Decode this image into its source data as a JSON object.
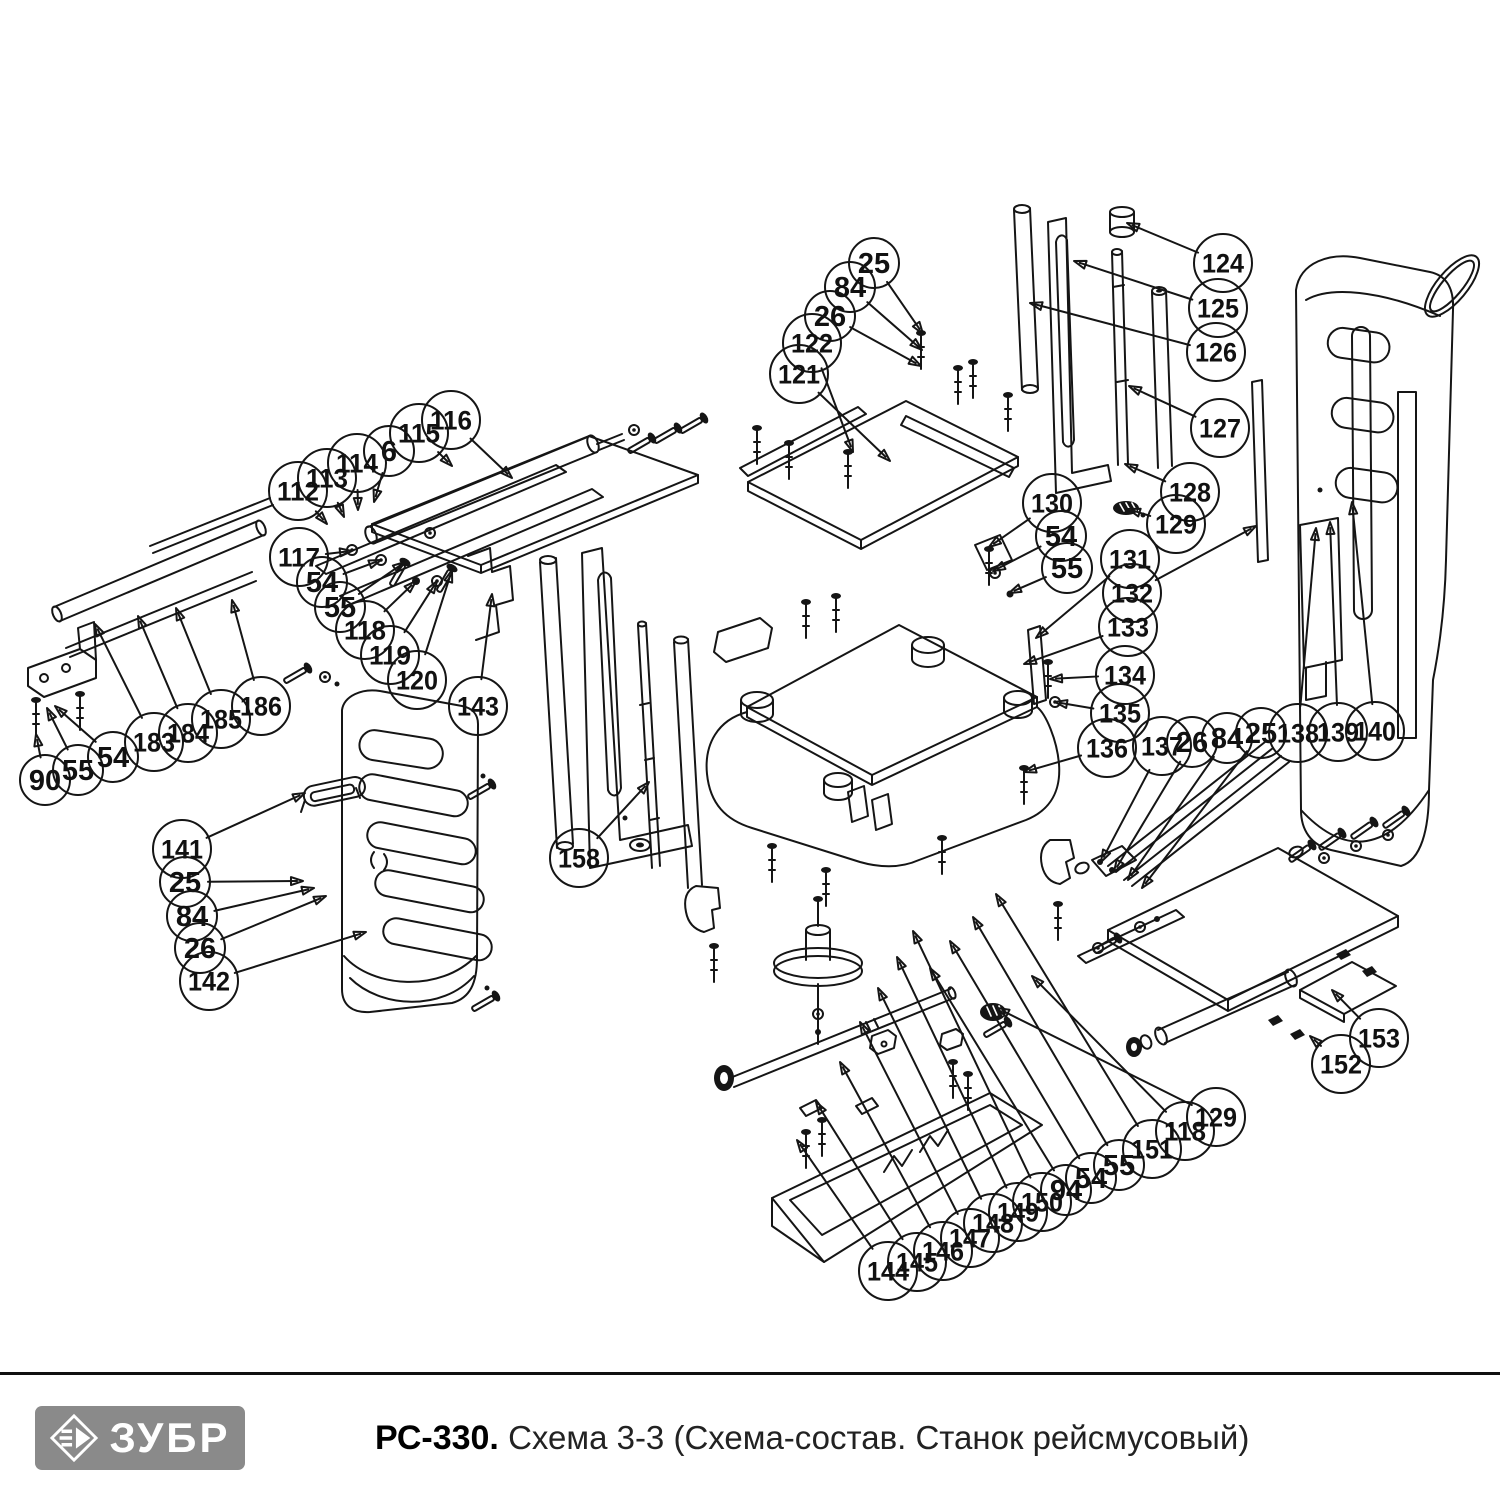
{
  "footer": {
    "brand": "ЗУБР",
    "model": "РС-330.",
    "subtitle": "Схема 3-3 (Схема-состав. Станок рейсмусовый)"
  },
  "colors": {
    "line": "#151515",
    "logo_bg": "#8a8a8a",
    "logo_fg": "#ffffff",
    "subtitle_text": "#222222"
  },
  "callouts": [
    {
      "label": "116",
      "x": 451,
      "y": 420,
      "tx": 512,
      "ty": 478
    },
    {
      "label": "115",
      "x": 419,
      "y": 433,
      "tx": 452,
      "ty": 466
    },
    {
      "label": "6",
      "x": 389,
      "y": 451,
      "tx": 374,
      "ty": 502
    },
    {
      "label": "114",
      "x": 357,
      "y": 463,
      "tx": 358,
      "ty": 510
    },
    {
      "label": "113",
      "x": 327,
      "y": 478,
      "tx": 344,
      "ty": 517
    },
    {
      "label": "112",
      "x": 298,
      "y": 491,
      "tx": 327,
      "ty": 524
    },
    {
      "label": "117",
      "x": 299,
      "y": 557,
      "tx": 352,
      "ty": 551
    },
    {
      "label": "54",
      "x": 322,
      "y": 582,
      "tx": 381,
      "ty": 560
    },
    {
      "label": "55",
      "x": 340,
      "y": 607,
      "tx": 405,
      "ty": 562
    },
    {
      "label": "118",
      "x": 365,
      "y": 630,
      "tx": 416,
      "ty": 581
    },
    {
      "label": "119",
      "x": 390,
      "y": 655,
      "tx": 437,
      "ty": 581
    },
    {
      "label": "120",
      "x": 417,
      "y": 680,
      "tx": 452,
      "ty": 570
    },
    {
      "label": "143",
      "x": 478,
      "y": 706,
      "tx": 492,
      "ty": 594
    },
    {
      "label": "90",
      "x": 45,
      "y": 780,
      "tx": 36,
      "ty": 734
    },
    {
      "label": "55",
      "x": 78,
      "y": 770,
      "tx": 47,
      "ty": 708
    },
    {
      "label": "54",
      "x": 113,
      "y": 757,
      "tx": 55,
      "ty": 706
    },
    {
      "label": "183",
      "x": 154,
      "y": 742,
      "tx": 95,
      "ty": 624
    },
    {
      "label": "184",
      "x": 188,
      "y": 733,
      "tx": 138,
      "ty": 616
    },
    {
      "label": "185",
      "x": 221,
      "y": 719,
      "tx": 176,
      "ty": 608
    },
    {
      "label": "186",
      "x": 261,
      "y": 706,
      "tx": 232,
      "ty": 600
    },
    {
      "label": "141",
      "x": 182,
      "y": 849,
      "tx": 305,
      "ty": 793
    },
    {
      "label": "25",
      "x": 185,
      "y": 882,
      "tx": 303,
      "ty": 881
    },
    {
      "label": "84",
      "x": 192,
      "y": 916,
      "tx": 314,
      "ty": 888
    },
    {
      "label": "26",
      "x": 200,
      "y": 948,
      "tx": 326,
      "ty": 896
    },
    {
      "label": "142",
      "x": 209,
      "y": 981,
      "tx": 366,
      "ty": 932
    },
    {
      "label": "158",
      "x": 579,
      "y": 858,
      "tx": 649,
      "ty": 782
    },
    {
      "label": "25",
      "x": 874,
      "y": 263,
      "tx": 923,
      "ty": 334
    },
    {
      "label": "84",
      "x": 850,
      "y": 287,
      "tx": 922,
      "ty": 350
    },
    {
      "label": "26",
      "x": 830,
      "y": 316,
      "tx": 921,
      "ty": 366
    },
    {
      "label": "122",
      "x": 812,
      "y": 343,
      "tx": 853,
      "ty": 452
    },
    {
      "label": "121",
      "x": 799,
      "y": 374,
      "tx": 890,
      "ty": 461
    },
    {
      "label": "124",
      "x": 1223,
      "y": 263,
      "tx": 1127,
      "ty": 223
    },
    {
      "label": "125",
      "x": 1218,
      "y": 308,
      "tx": 1074,
      "ty": 261
    },
    {
      "label": "126",
      "x": 1216,
      "y": 352,
      "tx": 1030,
      "ty": 303
    },
    {
      "label": "127",
      "x": 1220,
      "y": 428,
      "tx": 1129,
      "ty": 386
    },
    {
      "label": "128",
      "x": 1190,
      "y": 492,
      "tx": 1125,
      "ty": 464
    },
    {
      "label": "129",
      "x": 1176,
      "y": 524,
      "tx": 1128,
      "ty": 509
    },
    {
      "label": "130",
      "x": 1052,
      "y": 503,
      "tx": 989,
      "ty": 547
    },
    {
      "label": "54",
      "x": 1061,
      "y": 536,
      "tx": 993,
      "ty": 571
    },
    {
      "label": "55",
      "x": 1067,
      "y": 568,
      "tx": 1009,
      "ty": 593
    },
    {
      "label": "131",
      "x": 1130,
      "y": 559,
      "tx": 1036,
      "ty": 638
    },
    {
      "label": "132",
      "x": 1132,
      "y": 593,
      "tx": 1256,
      "ty": 526
    },
    {
      "label": "133",
      "x": 1128,
      "y": 627,
      "tx": 1024,
      "ty": 664
    },
    {
      "label": "134",
      "x": 1125,
      "y": 675,
      "tx": 1050,
      "ty": 679
    },
    {
      "label": "135",
      "x": 1120,
      "y": 713,
      "tx": 1055,
      "ty": 702
    },
    {
      "label": "136",
      "x": 1107,
      "y": 748,
      "tx": 1024,
      "ty": 772
    },
    {
      "label": "137",
      "x": 1162,
      "y": 746,
      "tx": 1101,
      "ty": 862
    },
    {
      "label": "26",
      "x": 1192,
      "y": 742,
      "tx": 1114,
      "ty": 872
    },
    {
      "label": "84",
      "x": 1227,
      "y": 738,
      "tx": 1128,
      "ty": 880
    },
    {
      "label": "25",
      "x": 1261,
      "y": 733,
      "tx": 1142,
      "ty": 888
    },
    {
      "label": "138",
      "x": 1298,
      "y": 733,
      "tx": 1316,
      "ty": 528
    },
    {
      "label": "139",
      "x": 1338,
      "y": 732,
      "tx": 1330,
      "ty": 522
    },
    {
      "label": "140",
      "x": 1375,
      "y": 731,
      "tx": 1352,
      "ty": 502
    },
    {
      "label": "144",
      "x": 888,
      "y": 1271,
      "tx": 797,
      "ty": 1140
    },
    {
      "label": "145",
      "x": 917,
      "y": 1262,
      "tx": 816,
      "ty": 1102
    },
    {
      "label": "146",
      "x": 943,
      "y": 1251,
      "tx": 840,
      "ty": 1062
    },
    {
      "label": "147",
      "x": 970,
      "y": 1238,
      "tx": 860,
      "ty": 1022
    },
    {
      "label": "148",
      "x": 993,
      "y": 1223,
      "tx": 878,
      "ty": 988
    },
    {
      "label": "149",
      "x": 1018,
      "y": 1212,
      "tx": 897,
      "ty": 957
    },
    {
      "label": "150",
      "x": 1042,
      "y": 1202,
      "tx": 913,
      "ty": 931
    },
    {
      "label": "94",
      "x": 1066,
      "y": 1190,
      "tx": 930,
      "ty": 968
    },
    {
      "label": "54",
      "x": 1091,
      "y": 1178,
      "tx": 950,
      "ty": 941
    },
    {
      "label": "55",
      "x": 1119,
      "y": 1165,
      "tx": 973,
      "ty": 917
    },
    {
      "label": "151",
      "x": 1152,
      "y": 1149,
      "tx": 996,
      "ty": 894
    },
    {
      "label": "118",
      "x": 1185,
      "y": 1131,
      "tx": 1032,
      "ty": 976
    },
    {
      "label": "129",
      "x": 1216,
      "y": 1117,
      "tx": 997,
      "ty": 1008
    },
    {
      "label": "153",
      "x": 1379,
      "y": 1038,
      "tx": 1332,
      "ty": 990
    },
    {
      "label": "152",
      "x": 1341,
      "y": 1064,
      "tx": 1310,
      "ty": 1036
    }
  ]
}
